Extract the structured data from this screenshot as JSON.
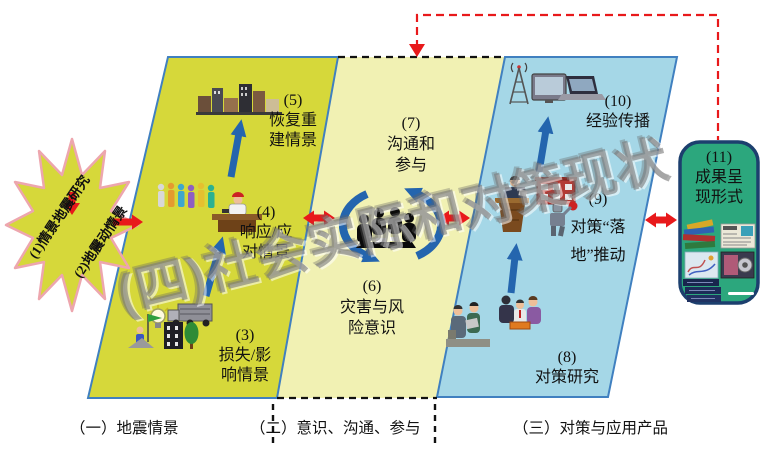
{
  "starburst": {
    "line1": "(1)情景地震研究",
    "line2": "(2)地震动情景"
  },
  "watermark": "(四)社会实际和对策现状",
  "nodes": {
    "n3": {
      "num": "(3)",
      "line1": "损失/影",
      "line2": "响情景"
    },
    "n4": {
      "num": "(4)",
      "line1": "响应/应",
      "line2": "对情景"
    },
    "n5": {
      "num": "(5)",
      "line1": "恢复重",
      "line2": "建情景"
    },
    "n6": {
      "num": "(6)",
      "line1": "灾害与风",
      "line2": "险意识"
    },
    "n7": {
      "num": "(7)",
      "line1": "沟通和",
      "line2": "参与"
    },
    "n8": {
      "num": "(8)",
      "line1": "对策研究"
    },
    "n9": {
      "num": "(9)",
      "line1": "对策“落",
      "line2": "地”推动"
    },
    "n10": {
      "num": "(10)",
      "line1": "经验传播"
    },
    "n11": {
      "num": "(11)",
      "line1": "成果呈",
      "line2": "现形式"
    }
  },
  "footer": {
    "s1": "（一）地震情景",
    "s2": "（二）意识、沟通、参与",
    "s3": "（三）对策与应用产品"
  },
  "colors": {
    "stage1_fill": "#d6d83a",
    "stage2_fill": "#f1f1b3",
    "stage3_fill": "#a5d7e7",
    "stage_border": "#4080c0",
    "starburst_fill": "#d6d83a",
    "starburst_stroke": "#eda6ae",
    "results_box_fill": "#2ca77d",
    "results_box_border": "#1c3f6e",
    "red_arrow": "#e8191b",
    "blue_arrow": "#2465ae",
    "watermark_gray": "#7d7d7d"
  },
  "icons": [
    "city-skyline-icon",
    "crowd-icon",
    "desk-officer-icon",
    "lightbulb-icon",
    "truck-icon",
    "flag-climber-icon",
    "damaged-building-icon",
    "tree-icon",
    "meeting-silhouette-icon",
    "cycle-arrows-icon",
    "radio-tower-icon",
    "tv-icon",
    "laptop-icon",
    "podium-speaker-icon",
    "school-building-icon",
    "robot-icon",
    "survey-team-icon",
    "discussion-group-icon",
    "books-pile-icon",
    "newspaper-icon",
    "map-icon",
    "media-player-icon",
    "report-stack-icon",
    "pen-icon"
  ]
}
